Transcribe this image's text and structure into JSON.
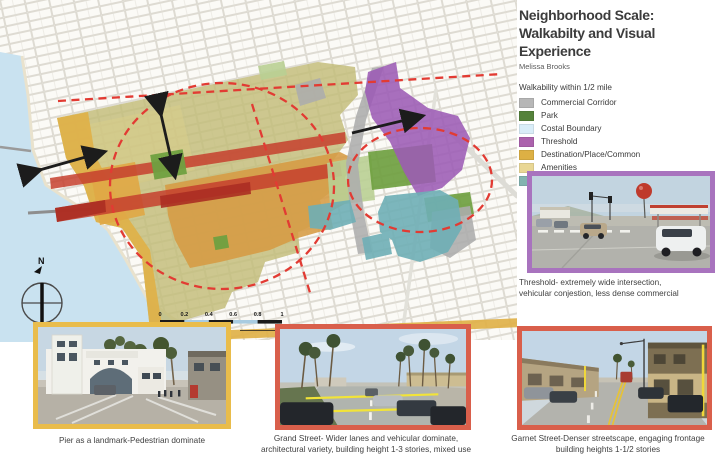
{
  "header": {
    "title_line1": "Neighborhood Scale:",
    "title_line2": "Walkabilty and Visual Experience",
    "author": "Melissa Brooks"
  },
  "legend": {
    "title": "Walkability within 1/2 mile",
    "items": [
      {
        "label": "Commercial Corridor",
        "color": "#b7b7b7"
      },
      {
        "label": "Park",
        "color": "#55823b"
      },
      {
        "label": "Costal Boundary",
        "color": "#d9edf8"
      },
      {
        "label": "Threshold",
        "color": "#ac62ad"
      },
      {
        "label": "Destination/Place/Common",
        "color": "#ddb044"
      },
      {
        "label": "Amenities",
        "color": "#e9d795"
      },
      {
        "label": "Resdential",
        "color": "#83b4b0"
      }
    ]
  },
  "map": {
    "compass_label": "N",
    "scale_bar": {
      "ticks": [
        "0",
        "0.2",
        "0.4",
        "0.6",
        "0.8",
        "1"
      ],
      "unit": "miles"
    },
    "zone_colors": {
      "walkshed": "#c2bc77",
      "coastal_band": "#e0b148",
      "destination": "#d69b43",
      "corridor_red": "#c5402e",
      "park_green": "#6fa040",
      "threshold_purple": "#9c5bb5",
      "residential_teal": "#6fafb6",
      "commercial_gray": "#adadad",
      "water": "#c9e2f0"
    }
  },
  "photos": {
    "threshold": {
      "border_color": "#a873be",
      "caption_line1": "Threshold- extremely wide intersection,",
      "caption_line2": "vehicular conjestion, less dense commercial"
    },
    "pier": {
      "border_color": "#e9bc4b",
      "caption": "Pier as a landmark-Pedestrian dominate"
    },
    "grand": {
      "border_color": "#d95f4b",
      "caption_line1": "Grand Street- Wider lanes and vehicular dominate,",
      "caption_line2": "architectural variety, building height 1-3 stories, mixed use"
    },
    "garnet": {
      "border_color": "#d95f4b",
      "caption_line1": "Garnet Street-Denser streetscape, engaging frontage",
      "caption_line2": "building heights 1-1/2 stories"
    }
  }
}
